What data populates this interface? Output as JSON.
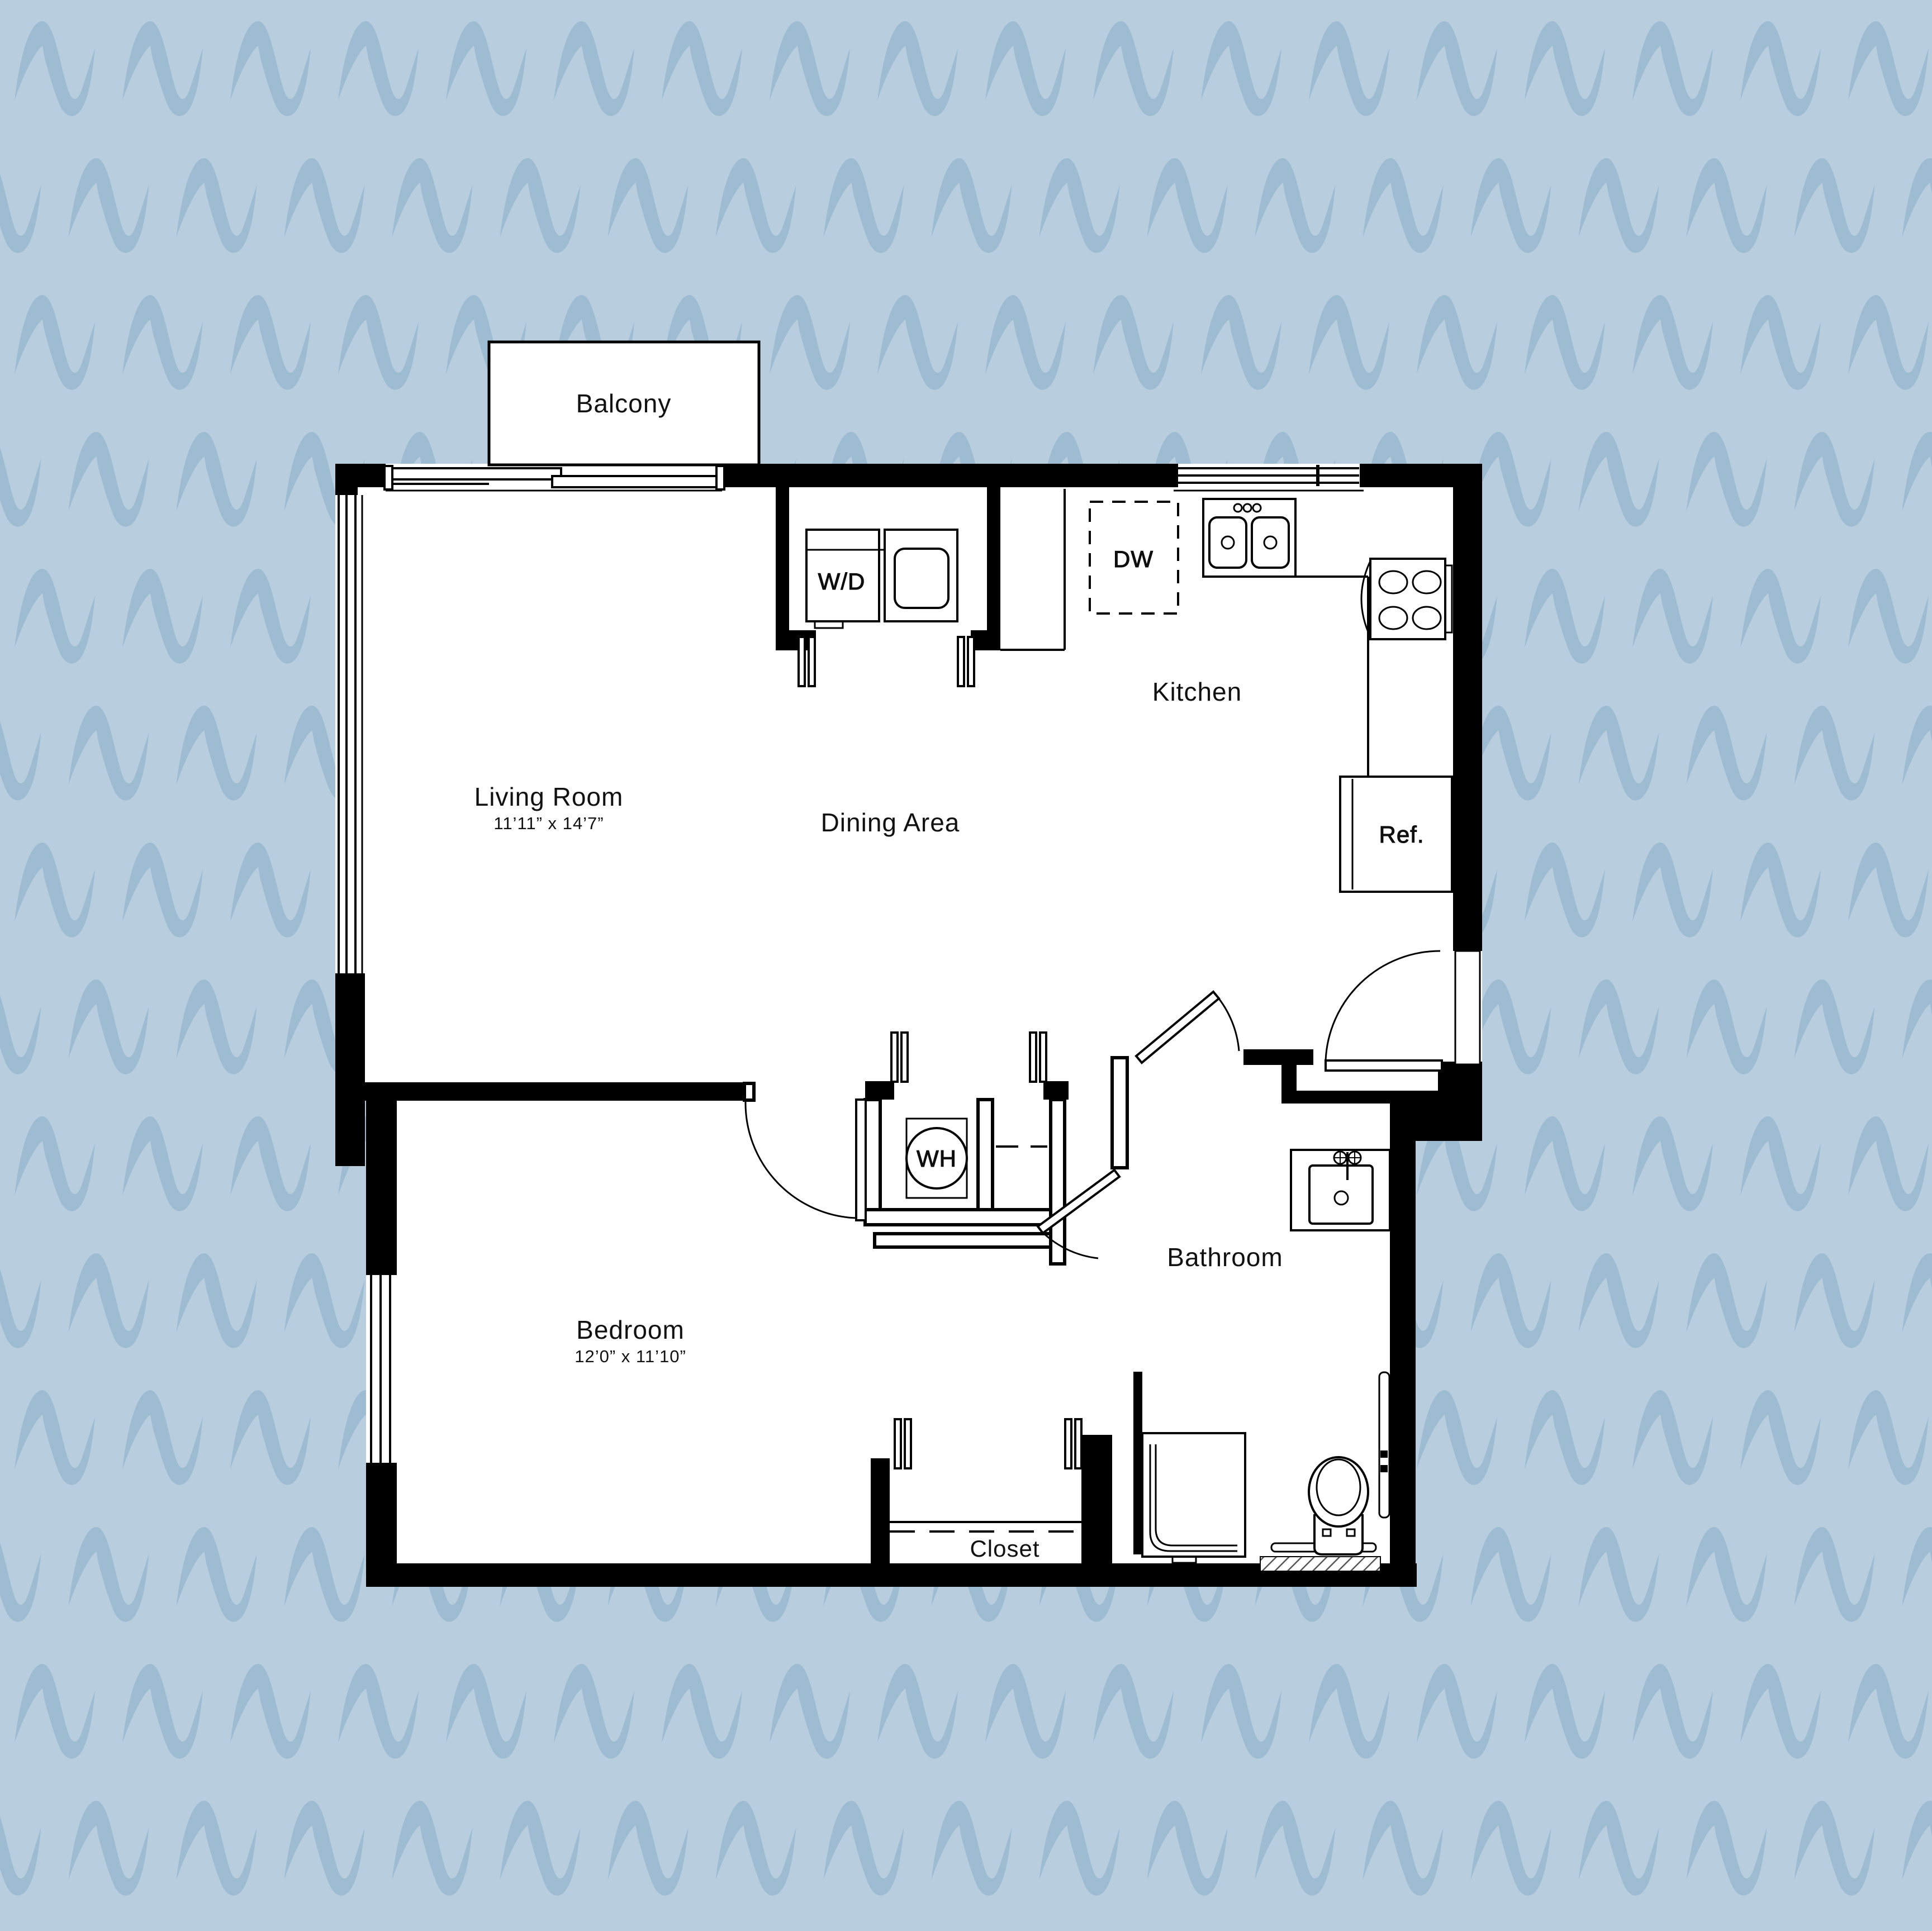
{
  "scene": {
    "type": "apartment-floor-plan",
    "description": "One-bedroom apartment floor plan on wavy blue patterned background"
  },
  "colors": {
    "background": "#b8cedf",
    "pattern_wave": "#9dbbd1",
    "plan_fill": "#ffffff",
    "wall": "#000000"
  },
  "rooms": {
    "balcony": {
      "label": "Balcony"
    },
    "living_room": {
      "label": "Living Room",
      "dimensions": "11’11” x 14’7”"
    },
    "dining_area": {
      "label": "Dining Area"
    },
    "kitchen": {
      "label": "Kitchen"
    },
    "bedroom": {
      "label": "Bedroom",
      "dimensions": "12’0” x 11’10”"
    },
    "bathroom": {
      "label": "Bathroom"
    },
    "closet": {
      "label": "Closet"
    }
  },
  "fixtures": {
    "dishwasher": {
      "label": "DW"
    },
    "refrigerator": {
      "label": "Ref."
    },
    "washer_dryer": {
      "label": "W/D"
    },
    "water_heater": {
      "label": "WH"
    }
  }
}
